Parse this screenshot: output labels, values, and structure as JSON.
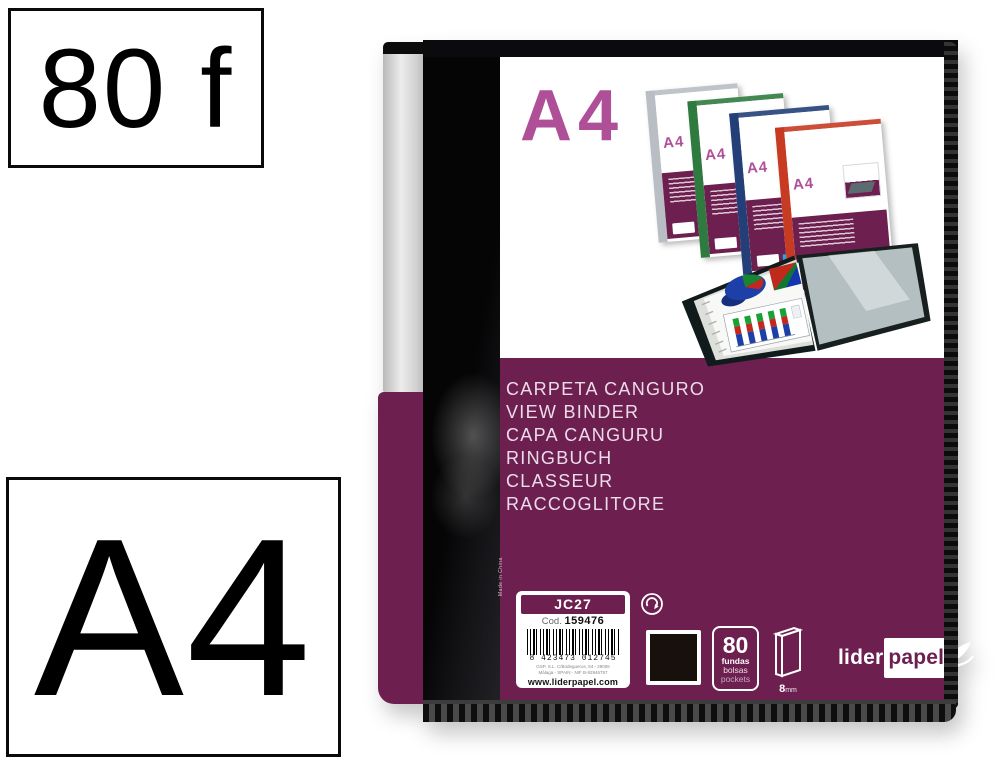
{
  "annotations": {
    "sheets": "80 f",
    "format": "A4"
  },
  "binder": {
    "format_label": "A4",
    "languages": [
      "CARPETA CANGURO",
      "VIEW BINDER",
      "CAPA CANGURU",
      "RINGBUCH",
      "CLASSEUR",
      "RACCOGLITORE"
    ],
    "label": {
      "model": "JC27",
      "code_prefix": "Cod.",
      "code_number": "159476",
      "barcode_digits": "8 423473 012745",
      "address_line1": "GSP, S.L. C/Bodegueros, 54 - 29006",
      "address_line2": "Málaga - SPAIN - NIF B-92946757",
      "website": "www.liderpapel.com",
      "made_in": "Made in China"
    },
    "badges": {
      "pockets_count": "80",
      "word_fundas": "fundas",
      "word_bolsas": "bolsas",
      "word_pockets": "pockets",
      "spine_mm": "8",
      "spine_unit": "mm"
    },
    "logo": {
      "part1": "lider",
      "part2": "papel"
    },
    "colors": {
      "purple_band": "#6d2050",
      "pink_a4": "#ae4f98",
      "cover_black": "#0c0c0e",
      "swatch_black": "#17100c",
      "label_strip_silver": "#d9d9d9"
    }
  },
  "montage": {
    "binders": [
      {
        "label": "A4",
        "spine_color": "#b9bec4"
      },
      {
        "label": "A4",
        "spine_color": "#2f7a3f"
      },
      {
        "label": "A4",
        "spine_color": "#243f78"
      },
      {
        "label": "A4",
        "spine_color": "#c63b22"
      }
    ]
  }
}
